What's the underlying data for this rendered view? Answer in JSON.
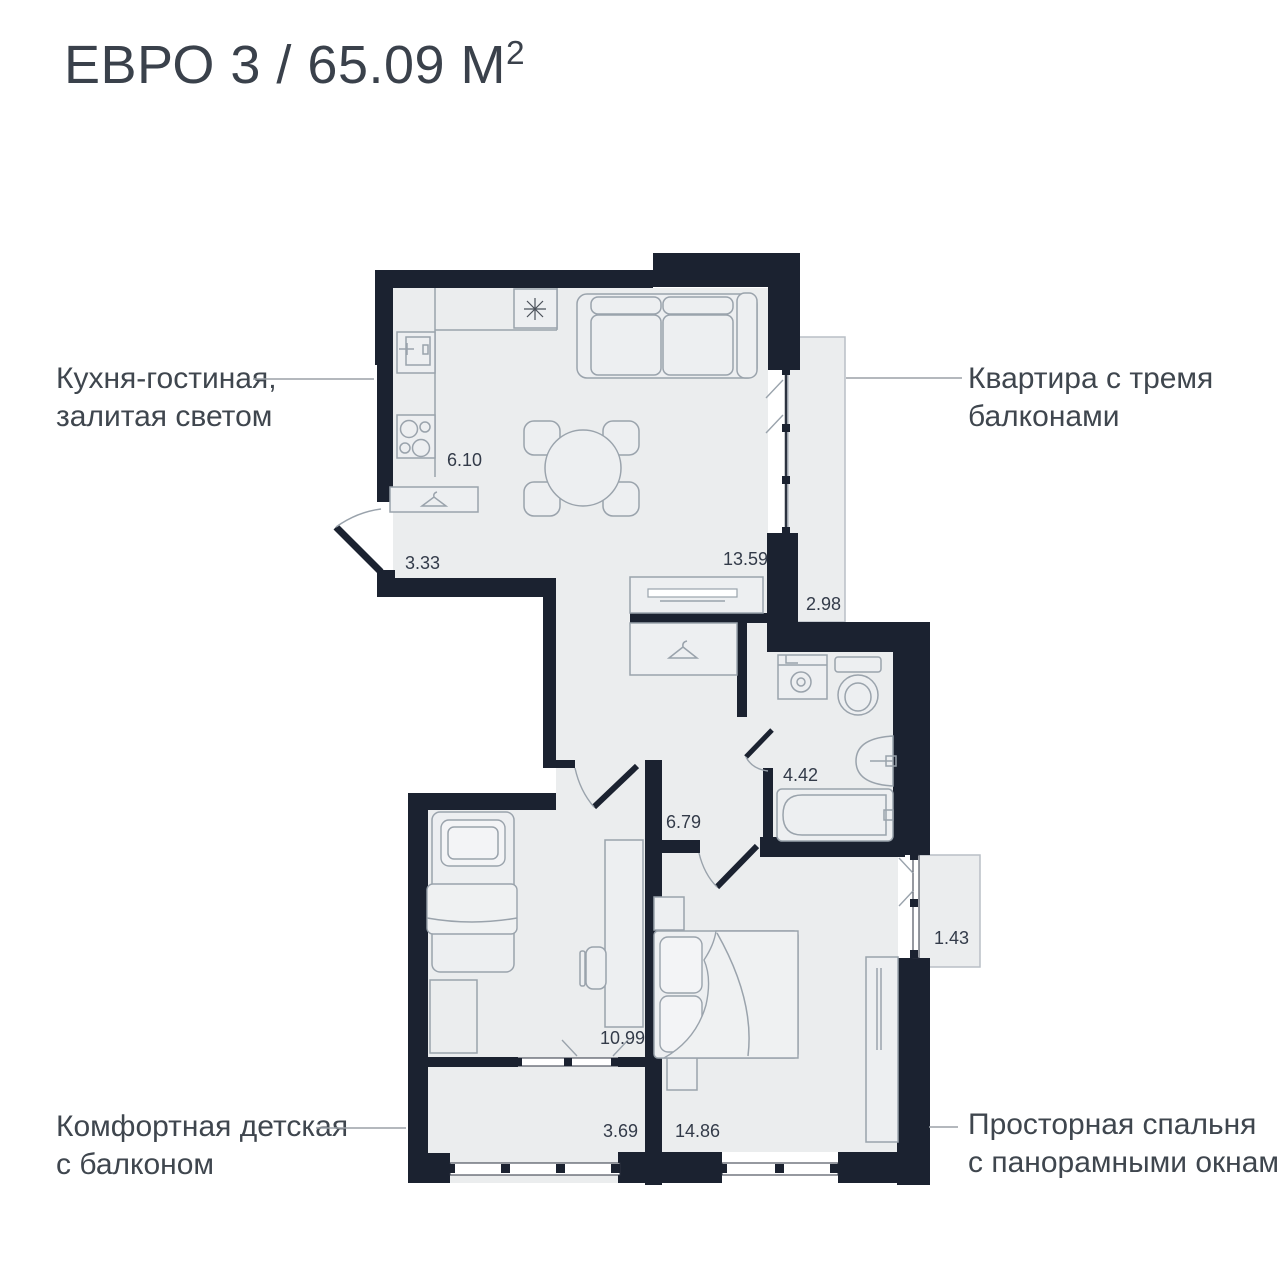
{
  "title": {
    "main": "ЕВРО 3 / 65.09 М",
    "sup": "2"
  },
  "labels": {
    "kitchen": {
      "line1": "Кухня-гостиная,",
      "line2": "залитая светом"
    },
    "balconies": {
      "line1": "Квартира с тремя",
      "line2": "балконами"
    },
    "kids": {
      "line1": "Комфортная детская",
      "line2": "с балконом"
    },
    "bedroom": {
      "line1": "Просторная спальня",
      "line2": "с панорамными окнами"
    }
  },
  "areas": {
    "kitchen_zone": "6.10",
    "entry": "3.33",
    "living": "13.59",
    "balcony_living": "2.98",
    "bathroom": "4.42",
    "hallway": "6.79",
    "kids_room": "10.99",
    "balcony_bedroom": "1.43",
    "balcony_kids": "3.69",
    "bedroom": "14.86"
  },
  "colors": {
    "wall": "#1b2230",
    "floor": "#ebedee",
    "furniture_line": "#9aa3ac",
    "area_text": "#333b49",
    "label_text": "#3f464e",
    "balcony_border": "#b9bfc6"
  }
}
